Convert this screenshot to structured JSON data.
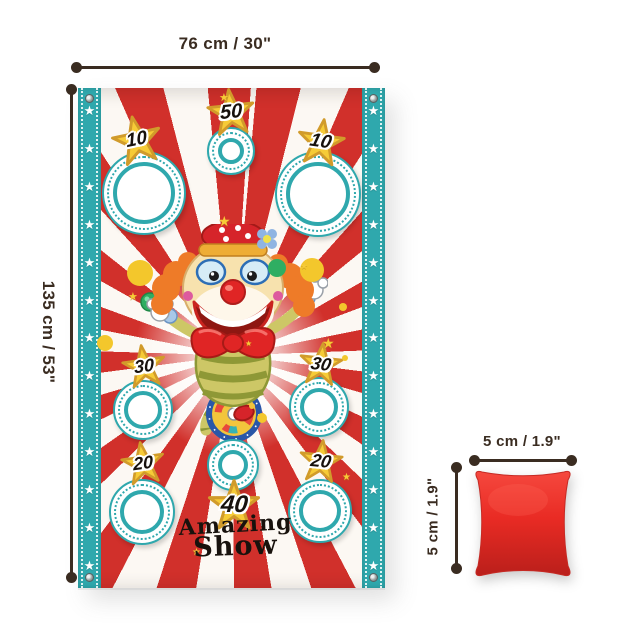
{
  "dimensions": {
    "banner_width": "76 cm / 30\"",
    "banner_height": "135 cm / 53\"",
    "bag_width": "5 cm / 1.9\"",
    "bag_height": "5 cm / 1.9\""
  },
  "banner": {
    "title_line1": "Amazing",
    "title_line2": "Show",
    "border_star_count": 13,
    "star_char": "★",
    "holes": [
      {
        "x": 66,
        "y": 105,
        "r": 42
      },
      {
        "x": 153,
        "y": 63,
        "r": 24
      },
      {
        "x": 240,
        "y": 106,
        "r": 43
      },
      {
        "x": 65,
        "y": 322,
        "r": 30
      },
      {
        "x": 241,
        "y": 319,
        "r": 30
      },
      {
        "x": 155,
        "y": 377,
        "r": 26
      },
      {
        "x": 64,
        "y": 424,
        "r": 33
      },
      {
        "x": 242,
        "y": 423,
        "r": 32
      }
    ],
    "scores": [
      {
        "value": "10",
        "x": 59,
        "y": 52,
        "size": 50,
        "rot": -12,
        "font": 19
      },
      {
        "value": "50",
        "x": 153,
        "y": 24,
        "size": 48,
        "rot": -6,
        "font": 20
      },
      {
        "value": "10",
        "x": 243,
        "y": 54,
        "size": 48,
        "rot": 8,
        "font": 19
      },
      {
        "value": "30",
        "x": 66,
        "y": 278,
        "size": 44,
        "rot": -8,
        "font": 18
      },
      {
        "value": "30",
        "x": 243,
        "y": 276,
        "size": 44,
        "rot": 6,
        "font": 18
      },
      {
        "value": "20",
        "x": 65,
        "y": 375,
        "size": 44,
        "rot": -8,
        "font": 18
      },
      {
        "value": "20",
        "x": 243,
        "y": 373,
        "size": 44,
        "rot": 6,
        "font": 18
      },
      {
        "value": "40",
        "x": 156,
        "y": 417,
        "size": 52,
        "rot": 0,
        "font": 24
      }
    ],
    "decor_dots": [
      {
        "x": 62,
        "y": 185,
        "r": 13,
        "c": "#f3c72c"
      },
      {
        "x": 234,
        "y": 182,
        "r": 12,
        "c": "#f3c72c"
      },
      {
        "x": 199,
        "y": 180,
        "r": 9,
        "c": "#2fae62"
      },
      {
        "x": 27,
        "y": 255,
        "r": 8,
        "c": "#f3c72c"
      },
      {
        "x": 184,
        "y": 330,
        "r": 5,
        "c": "#f3c72c"
      },
      {
        "x": 265,
        "y": 219,
        "r": 4,
        "c": "#f3c72c"
      },
      {
        "x": 267,
        "y": 270,
        "r": 3,
        "c": "#f3c72c"
      }
    ],
    "decor_stars": [
      {
        "x": 140,
        "y": 126,
        "s": 14
      },
      {
        "x": 50,
        "y": 204,
        "s": 11
      },
      {
        "x": 244,
        "y": 248,
        "s": 14
      },
      {
        "x": 222,
        "y": 174,
        "s": 9
      },
      {
        "x": 264,
        "y": 385,
        "s": 10
      },
      {
        "x": 114,
        "y": 460,
        "s": 10
      },
      {
        "x": 141,
        "y": 5,
        "s": 11
      },
      {
        "x": 167,
        "y": 252,
        "s": 8
      }
    ],
    "colors": {
      "teal": "#2fa8ad",
      "stripe_red": "#d1302b",
      "star_yellow": "#f6cb37",
      "number": "#17110d"
    }
  },
  "beanbag": {
    "color": "#e92b24"
  }
}
